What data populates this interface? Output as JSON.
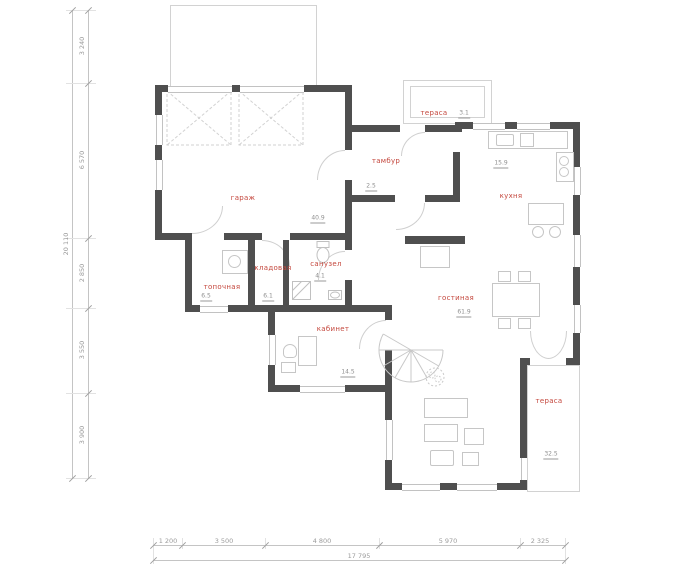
{
  "plan_title": "first-floor-plan",
  "rooms": [
    {
      "name": "гараж",
      "area": "40.9"
    },
    {
      "name": "тамбур",
      "area": "2.5"
    },
    {
      "name": "тераса",
      "area": "3.1"
    },
    {
      "name": "кухня",
      "area": "15.9"
    },
    {
      "name": "топочная",
      "area": "6.5"
    },
    {
      "name": "кладовая",
      "area": "6.1"
    },
    {
      "name": "санузел",
      "area": "4.1"
    },
    {
      "name": "кабинет",
      "area": "14.5"
    },
    {
      "name": "гостиная",
      "area": "61.9"
    },
    {
      "name": "тераса",
      "area": "32.5"
    }
  ],
  "dimensions": {
    "vertical": {
      "segments": [
        "3 240",
        "6 570",
        "2 850",
        "3 550",
        "3 900"
      ],
      "total": "20 110"
    },
    "horizontal": {
      "segments": [
        "1 200",
        "3 500",
        "4 800",
        "5 970",
        "2 325"
      ],
      "total": "17 795"
    }
  },
  "colors": {
    "wall": "#4f4f4f",
    "room_label": "#c4473d",
    "dimension_text": "#9b9b9b",
    "thin_line": "#d2d2d2",
    "marker": "#cc3b30"
  }
}
